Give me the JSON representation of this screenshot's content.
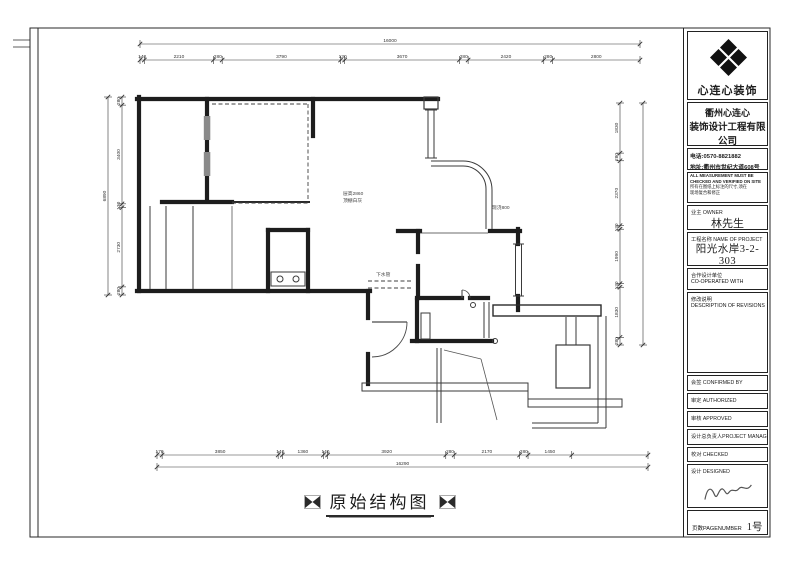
{
  "plan": {
    "title": "原始结构图",
    "notes": {
      "ceiling_height": "层高2860",
      "ceiling_finish": "顶棚白灰",
      "cast_slab": "现浇800",
      "drain": "下水管"
    },
    "dimensions": {
      "top_overall": [
        {
          "label": "16000",
          "mm": 16000
        }
      ],
      "top_segments": [
        {
          "label": "140",
          "mm": 140
        },
        {
          "label": "2210",
          "mm": 2210
        },
        {
          "label": "280",
          "mm": 280
        },
        {
          "label": "3790",
          "mm": 3790
        },
        {
          "label": "130",
          "mm": 130
        },
        {
          "label": "3670",
          "mm": 3670
        },
        {
          "label": "280",
          "mm": 280
        },
        {
          "label": "2420",
          "mm": 2420
        },
        {
          "label": "280",
          "mm": 280
        },
        {
          "label": "2800",
          "mm": 2800
        }
      ],
      "left_overall": [
        {
          "label": "6890",
          "mm": 6820
        }
      ],
      "left_segments": [
        {
          "label": "280",
          "mm": 280
        },
        {
          "label": "3400",
          "mm": 3400
        },
        {
          "label": "130",
          "mm": 130
        },
        {
          "label": "2730",
          "mm": 2730
        },
        {
          "label": "280",
          "mm": 280
        }
      ],
      "right_overall": [
        {
          "label": "",
          "mm": 8840
        }
      ],
      "right_segments": [
        {
          "label": "1830",
          "mm": 1830
        },
        {
          "label": "280",
          "mm": 280
        },
        {
          "label": "2370",
          "mm": 2370
        },
        {
          "label": "130",
          "mm": 130
        },
        {
          "label": "1990",
          "mm": 1990
        },
        {
          "label": "130",
          "mm": 130
        },
        {
          "label": "1830",
          "mm": 1830
        },
        {
          "label": "280",
          "mm": 280
        }
      ],
      "bottom_overall": [
        {
          "label": "16290",
          "mm": 16290
        }
      ],
      "bottom_segments": [
        {
          "label": "170",
          "mm": 170
        },
        {
          "label": "3850",
          "mm": 3850
        },
        {
          "label": "140",
          "mm": 140
        },
        {
          "label": "1360",
          "mm": 1360
        },
        {
          "label": "140",
          "mm": 140
        },
        {
          "label": "3920",
          "mm": 3920
        },
        {
          "label": "280",
          "mm": 280
        },
        {
          "label": "2170",
          "mm": 2170
        },
        {
          "label": "280",
          "mm": 280
        },
        {
          "label": "1450",
          "mm": 1450
        },
        {
          "label": "",
          "mm": 2530
        }
      ]
    }
  },
  "title_block": {
    "logo_text": "心连心装饰",
    "company_cn_1": "衢州心连心",
    "company_cn_2": "装饰设计工程有限公司",
    "company_en_1": "QU ZHOU XINLIANXIN",
    "company_en_2": "DECORATION DESIGN PROJECT CO.,LTD",
    "phone": "电话:0570-8821882",
    "address": "地址:衢州市世纪大道608号",
    "notice_en_1": "ALL MEASUREMENT MUST BE",
    "notice_en_2": "CHECKED AND VERIFIED ON SITE",
    "notice_cn_1": "所有在图纸上标注的尺寸,须在",
    "notice_cn_2": "现场复合和修正",
    "owner_label": "业主 OWNER",
    "owner_name": "林先生",
    "project_label": "工程名称 NAME OF PROJECT",
    "project_name": "阳光水岸3-2-303",
    "coop_label_cn": "合作设计单位",
    "coop_label_en": "CO-OPERATED WITH",
    "revisions_cn": "修改说明",
    "revisions_en": "DESCRIPTION OF REVISIONS",
    "confirmed_label": "会签 CONFIRMED BY",
    "authorized_label": "审定 AUTHORIZED",
    "approved_label": "审核 APPROVED",
    "manager_label": "设计总负责人PROJECT MANAGER",
    "checked_label": "校对 CHECKED",
    "designed_label": "设计 DESIGNED",
    "page_label": "页数PAGENUMBER",
    "page_value": "1号"
  }
}
